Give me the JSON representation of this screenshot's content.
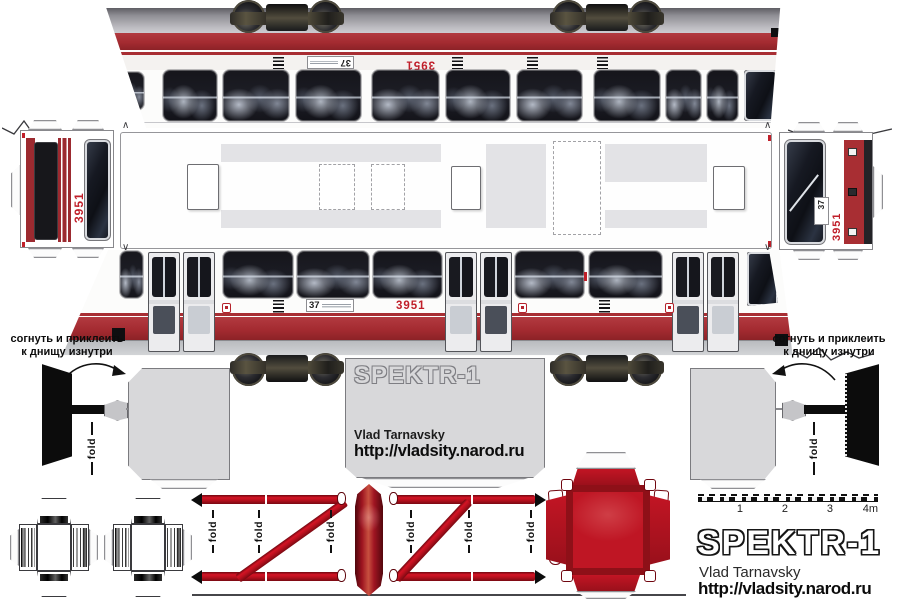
{
  "labels": {
    "route_number": "37",
    "car_number": "3951",
    "fold": "fold",
    "glue_note_line1": "согнуть и приклеить",
    "glue_note_line2": "к днищу изнутри"
  },
  "branding": {
    "title": "SPEKTR-1",
    "author": "Vlad Tarnavsky",
    "url": "http://vladsity.narod.ru"
  },
  "ruler": {
    "ticks": [
      "1",
      "2",
      "3",
      "4m"
    ]
  },
  "colors": {
    "band_red": "#a82e33",
    "bright_red": "#bf1624",
    "number_red": "#c01f2a",
    "floor_gray": "#d8d8da",
    "skirt_gray": "#c3c5c9"
  }
}
